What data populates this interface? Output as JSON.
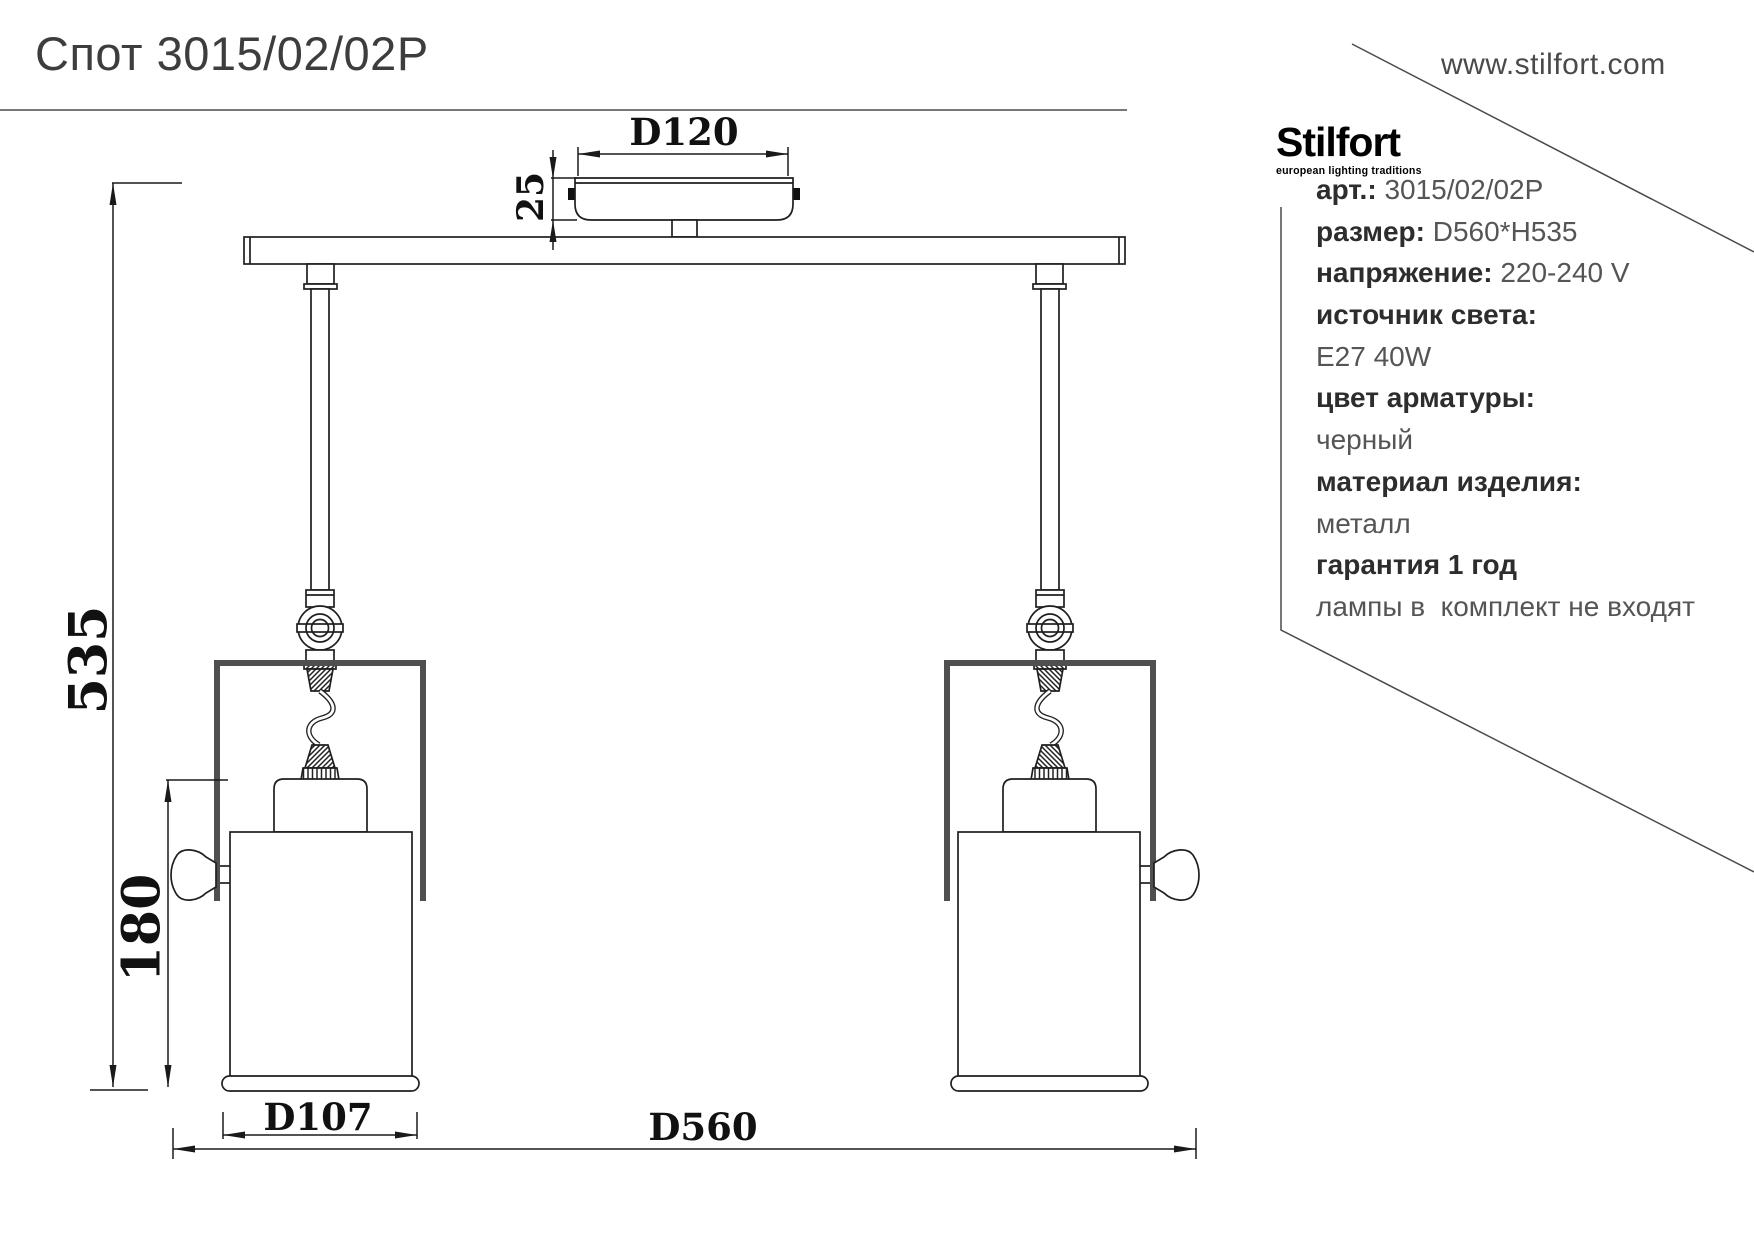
{
  "header": {
    "title": "Спот 3015/02/02P",
    "website": "www.stilfort.com",
    "brand": "Stilfort",
    "brand_tagline": "european lighting traditions"
  },
  "specs": {
    "art_label": "арт.:",
    "art_value": "3015/02/02P",
    "size_label": "размер:",
    "size_value": "D560*H535",
    "voltage_label": "напряжение:",
    "voltage_value": "220-240 V",
    "light_source_label": "источник света:",
    "light_source_value": "E27 40W",
    "armature_color_label": "цвет арматуры:",
    "armature_color_value": "черный",
    "material_label": "материал изделия:",
    "material_value": "металл",
    "warranty": "гарантия 1 год",
    "note": "лампы в  комплект не входят"
  },
  "dimensions": {
    "canopy_diameter": "D120",
    "canopy_height": "25",
    "overall_height": "535",
    "shade_height": "180",
    "shade_diameter": "D107",
    "overall_width": "D560"
  },
  "colors": {
    "drawing_line": "#1f1f1f",
    "bracket": "#4f4f4f",
    "panel_line": "#4a4a4a",
    "title_text": "#3d3d3d"
  }
}
